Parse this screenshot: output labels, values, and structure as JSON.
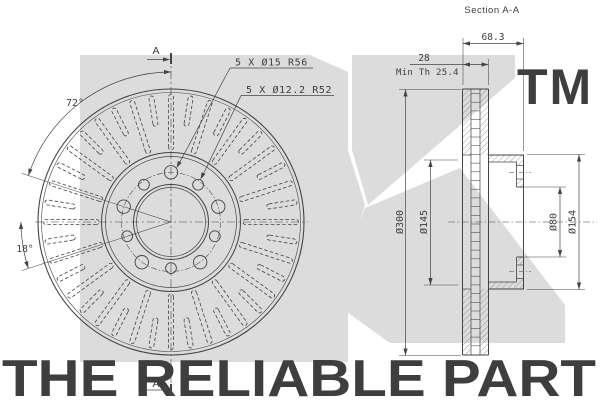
{
  "section_title": "Section A-A",
  "front_view": {
    "hole_pattern_large": "5 X Ø15 R56",
    "hole_pattern_small": "5 X Ø12.2 R52",
    "bolt_pattern_angle": "72°",
    "vane_angle": "18°",
    "section_marker_top": "A",
    "section_marker_bottom": "A"
  },
  "section_view": {
    "total_width": "68.3",
    "disc_thickness": "28",
    "min_thickness_note": "Min Th 25.4",
    "outer_diameter": "Ø300",
    "inner_diameter": "Ø145",
    "bore_diameter": "Ø80",
    "hub_diameter": "Ø154"
  },
  "watermark": {
    "trademark": "TM",
    "slogan": "THE RELIABLE PART"
  },
  "colors": {
    "line": "#444444",
    "watermark_shape": "#dcdcdc",
    "watermark_text": "#d4d4d4",
    "background": "#ffffff"
  }
}
